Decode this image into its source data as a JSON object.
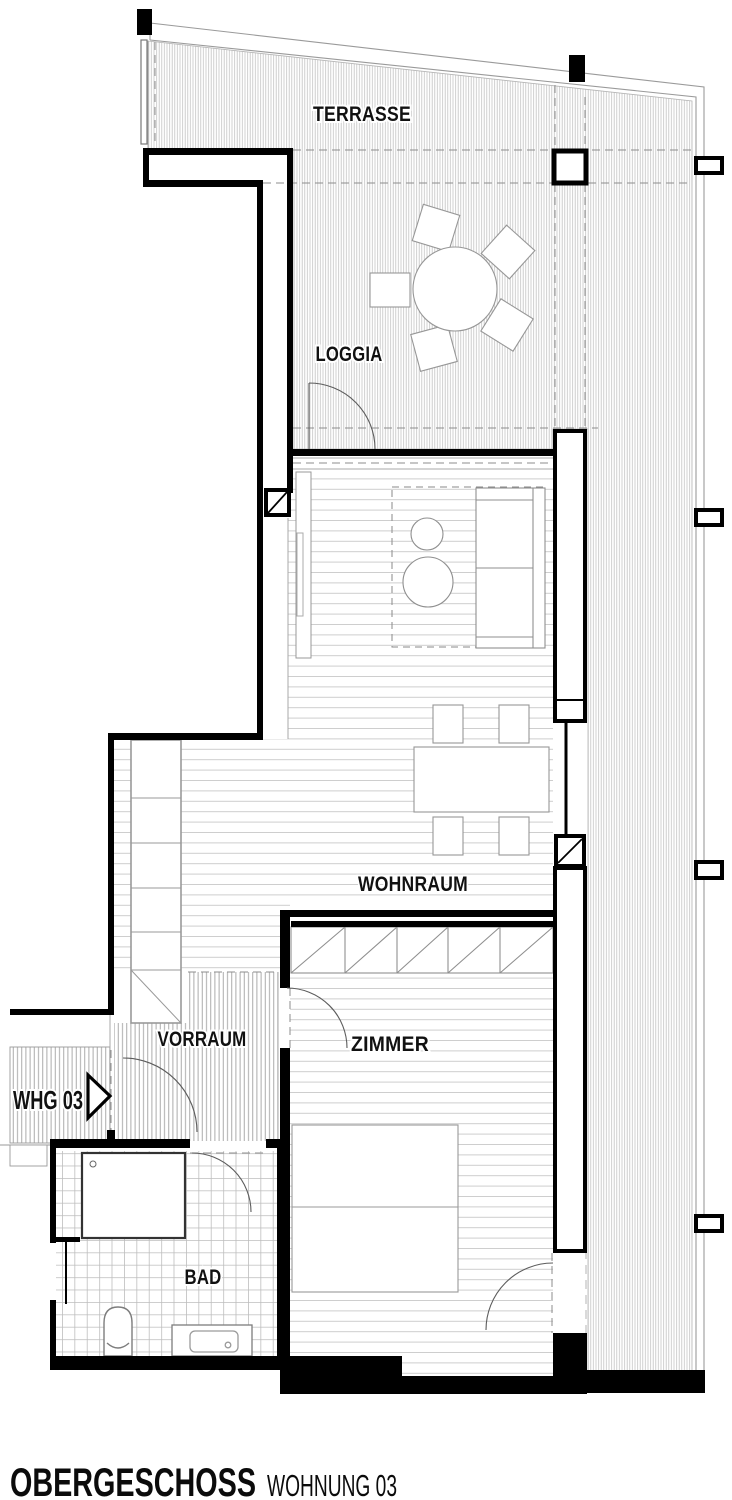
{
  "plan": {
    "rooms": {
      "terrasse": "TERRASSE",
      "loggia": "LOGGIA",
      "wohnraum": "WOHNRAUM",
      "vorraum": "VORRAUM",
      "zimmer": "ZIMMER",
      "bad": "BAD"
    },
    "entry_label": "WHG 03",
    "footer": {
      "title": "OBERGESCHOSS",
      "subtitle": "WOHNUNG 03"
    },
    "colors": {
      "wall": "#000000",
      "hatch_line": "#c4c4c4",
      "hatch_line_dense": "#ababab",
      "floor_line": "#cdcdcd",
      "tile_line": "#bdbdbd",
      "dash_line": "#8c8c8c",
      "furniture_line": "#8f8f8f",
      "background": "#ffffff"
    }
  }
}
